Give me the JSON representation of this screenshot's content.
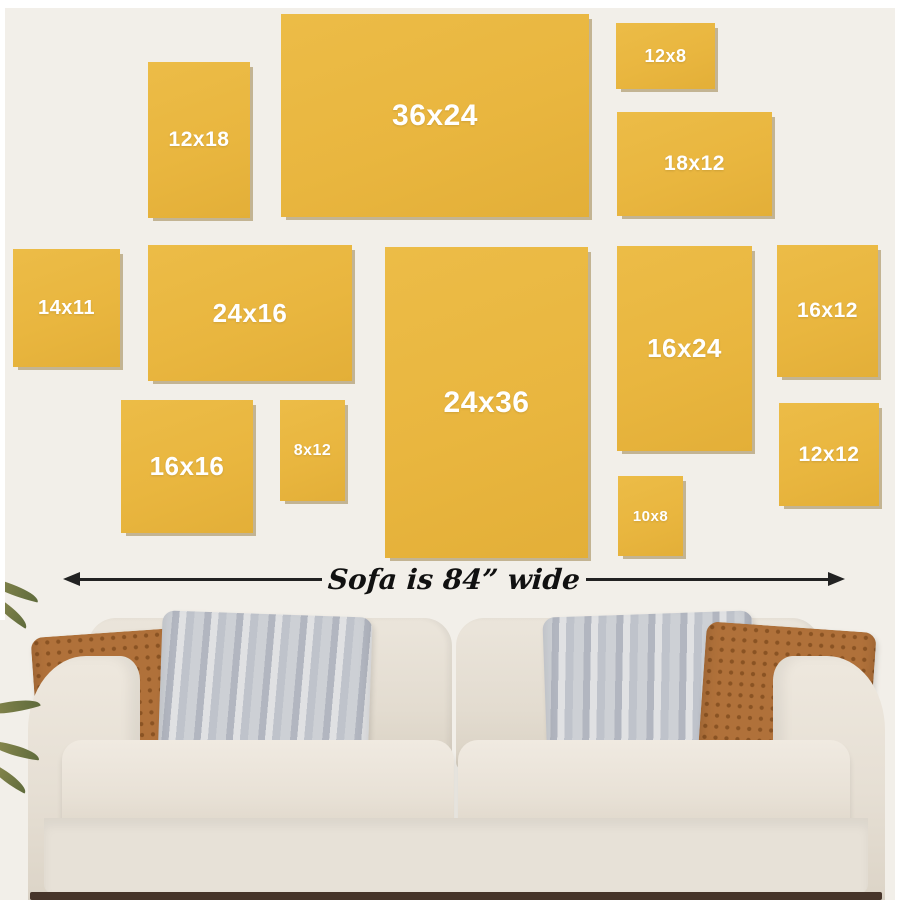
{
  "scene": {
    "description_label": "canvas wall art size comparison above sofa"
  },
  "panels": [
    {
      "id": "12x18",
      "label": "12x18"
    },
    {
      "id": "36x24",
      "label": "36x24"
    },
    {
      "id": "12x8",
      "label": "12x8"
    },
    {
      "id": "18x12",
      "label": "18x12"
    },
    {
      "id": "14x11",
      "label": "14x11"
    },
    {
      "id": "24x16",
      "label": "24x16"
    },
    {
      "id": "24x36",
      "label": "24x36"
    },
    {
      "id": "16x24",
      "label": "16x24"
    },
    {
      "id": "16x12",
      "label": "16x12"
    },
    {
      "id": "16x16",
      "label": "16x16"
    },
    {
      "id": "8x12",
      "label": "8x12"
    },
    {
      "id": "10x8",
      "label": "10x8"
    },
    {
      "id": "12x12",
      "label": "12x12"
    }
  ],
  "sofa": {
    "width_label": "Sofa is 84” wide"
  },
  "colors": {
    "canvas_yellow": "#e9b740",
    "canvas_shadow": "#826213",
    "wall_background": "#f2efe9",
    "arrow_black": "#222222",
    "sofa_beige": "#e7e1d7",
    "pillow_brown": "#b0713a",
    "pillow_gray": "#c5c8cf",
    "floor_dark": "#47352a",
    "leaf_green": "#6f753f"
  }
}
